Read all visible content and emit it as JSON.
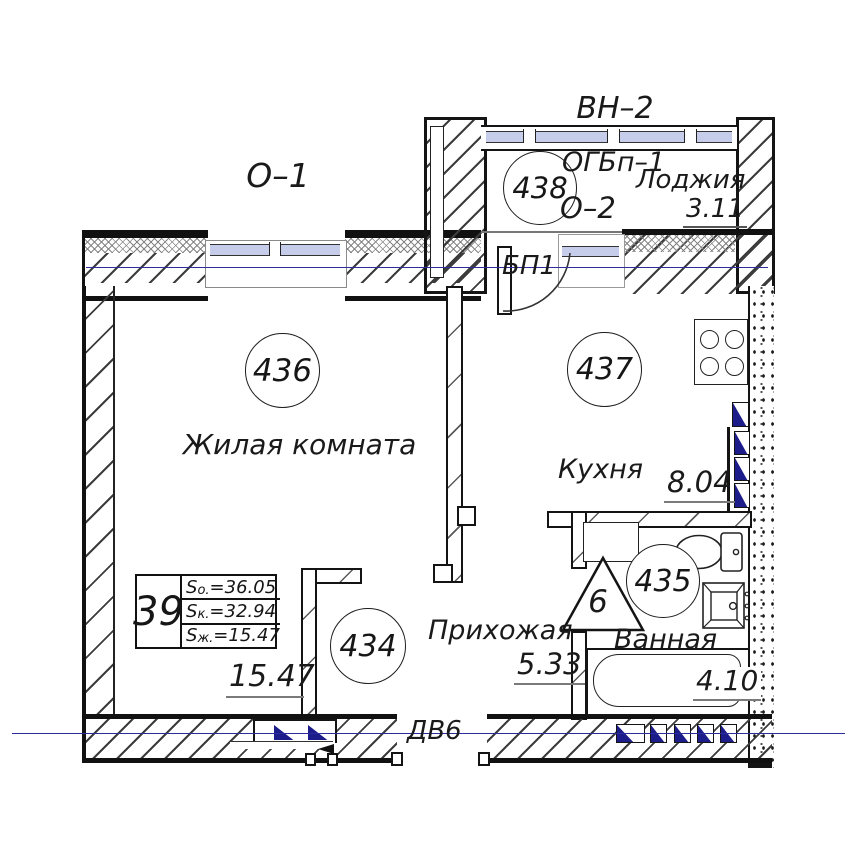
{
  "colors": {
    "line": "#1a1a1a",
    "centerline": "#2b2b9e",
    "marker_blue": "#1c1c8a",
    "glazing": "#c6cdeb"
  },
  "labels": {
    "vn2": "ВН–2",
    "o1": "О–1",
    "o2": "О–2",
    "ogbp1": "ОГБп–1",
    "bp1": "БП1",
    "dv6": "ДВ6",
    "shaft_number": "6"
  },
  "rooms": {
    "living": {
      "circle": "436",
      "name": "Жилая комната",
      "area": "15.47"
    },
    "kitchen": {
      "circle": "437",
      "name": "Кухня",
      "area": "8.04"
    },
    "bath": {
      "circle": "435",
      "name": "Ванная",
      "area": "4.10"
    },
    "hall": {
      "circle": "434",
      "name": "Прихожая",
      "area": "5.33"
    },
    "loggia": {
      "circle": "438",
      "name": "Лоджия",
      "area": "3.11"
    }
  },
  "info_table": {
    "apartment_number": "39",
    "rows": [
      {
        "prefix": "S",
        "sub": "о.",
        "value": "=36.05"
      },
      {
        "prefix": "S",
        "sub": "к.",
        "value": "=32.94"
      },
      {
        "prefix": "S",
        "sub": "ж.",
        "value": "=15.47"
      }
    ]
  }
}
